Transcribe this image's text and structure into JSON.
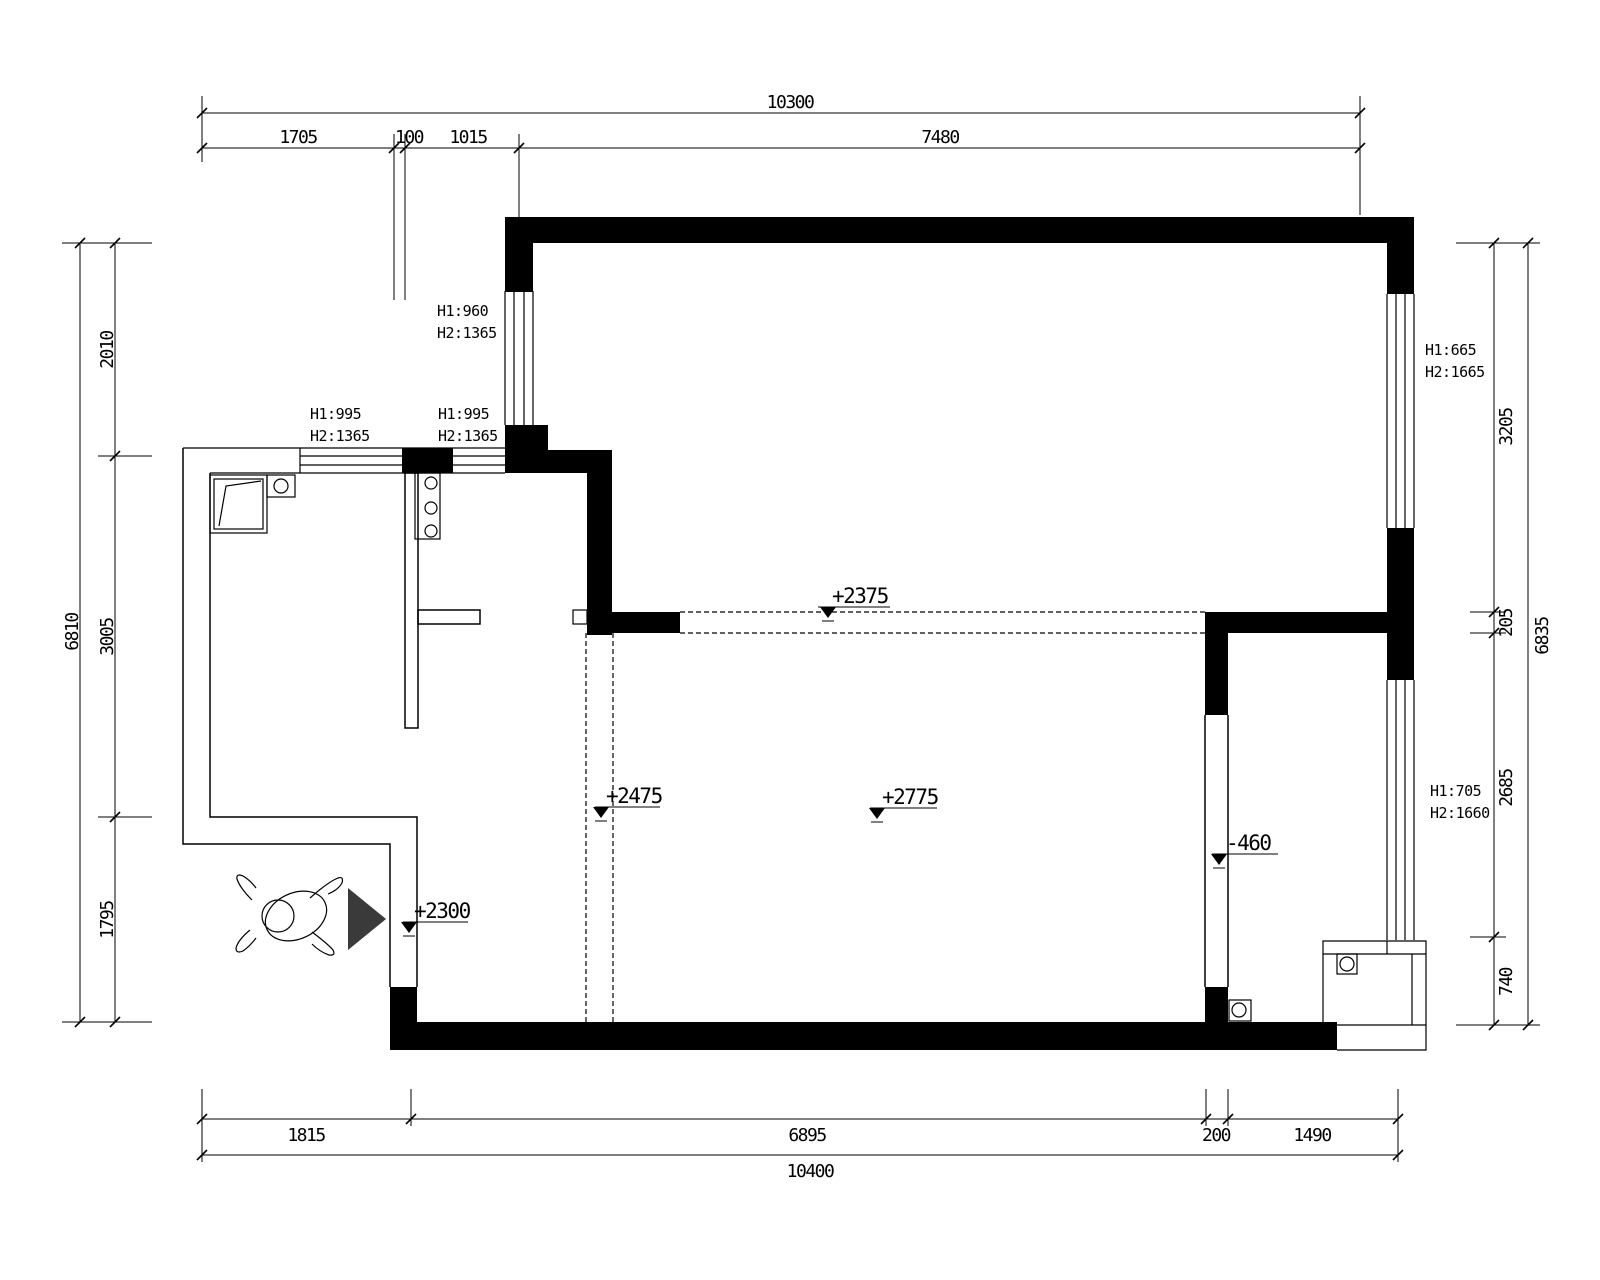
{
  "drawing": {
    "dims": {
      "top": {
        "overall": "10300",
        "segments": [
          "1705",
          "100",
          "1015",
          "7480"
        ]
      },
      "bottom": {
        "overall": "10400",
        "segments": [
          "1815",
          "6895",
          "200",
          "1490"
        ]
      },
      "left": {
        "overall": "6810",
        "segments": [
          "2010",
          "3005",
          "1795"
        ]
      },
      "right": {
        "overall": "6835",
        "segments": [
          "3205",
          "205",
          "2685",
          "740"
        ]
      }
    },
    "window_labels": [
      {
        "h1": "H1:960",
        "h2": "H2:1365"
      },
      {
        "h1": "H1:995",
        "h2": "H2:1365"
      },
      {
        "h1": "H1:995",
        "h2": "H2:1365"
      },
      {
        "h1": "H1:665",
        "h2": "H2:1665"
      },
      {
        "h1": "H1:705",
        "h2": "H2:1660"
      }
    ],
    "levels": {
      "living_beam": "+2375",
      "kitchen": "+2475",
      "living": "+2775",
      "entry": "+2300",
      "bath": "-460"
    },
    "colors": {
      "line": "#000000",
      "arrow": "#3a3a3a",
      "background": "#ffffff"
    }
  }
}
